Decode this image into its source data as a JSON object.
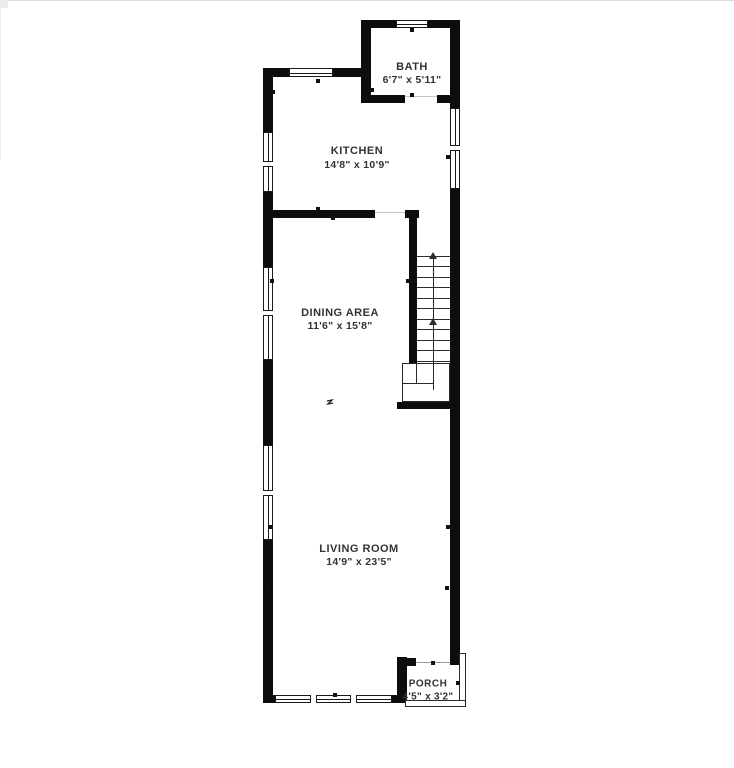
{
  "page": {
    "background": "#ffffff"
  },
  "floor_plan": {
    "rooms": [
      {
        "name": "BATH",
        "dimensions": "6'7\" x 5'11\""
      },
      {
        "name": "KITCHEN",
        "dimensions": "14'8\" x 10'9\""
      },
      {
        "name": "DINING AREA",
        "dimensions": "11'6\" x 15'8\""
      },
      {
        "name": "LIVING ROOM",
        "dimensions": "14'9\" x 23'5\""
      },
      {
        "name": "PORCH",
        "dimensions": "4'5\" x 3'2\""
      }
    ],
    "stairs": {
      "direction": "up"
    },
    "colors": {
      "wall": "#0d0d0d",
      "text": "#333333",
      "window_line": "#1a1a1a",
      "background": "#ffffff"
    }
  }
}
